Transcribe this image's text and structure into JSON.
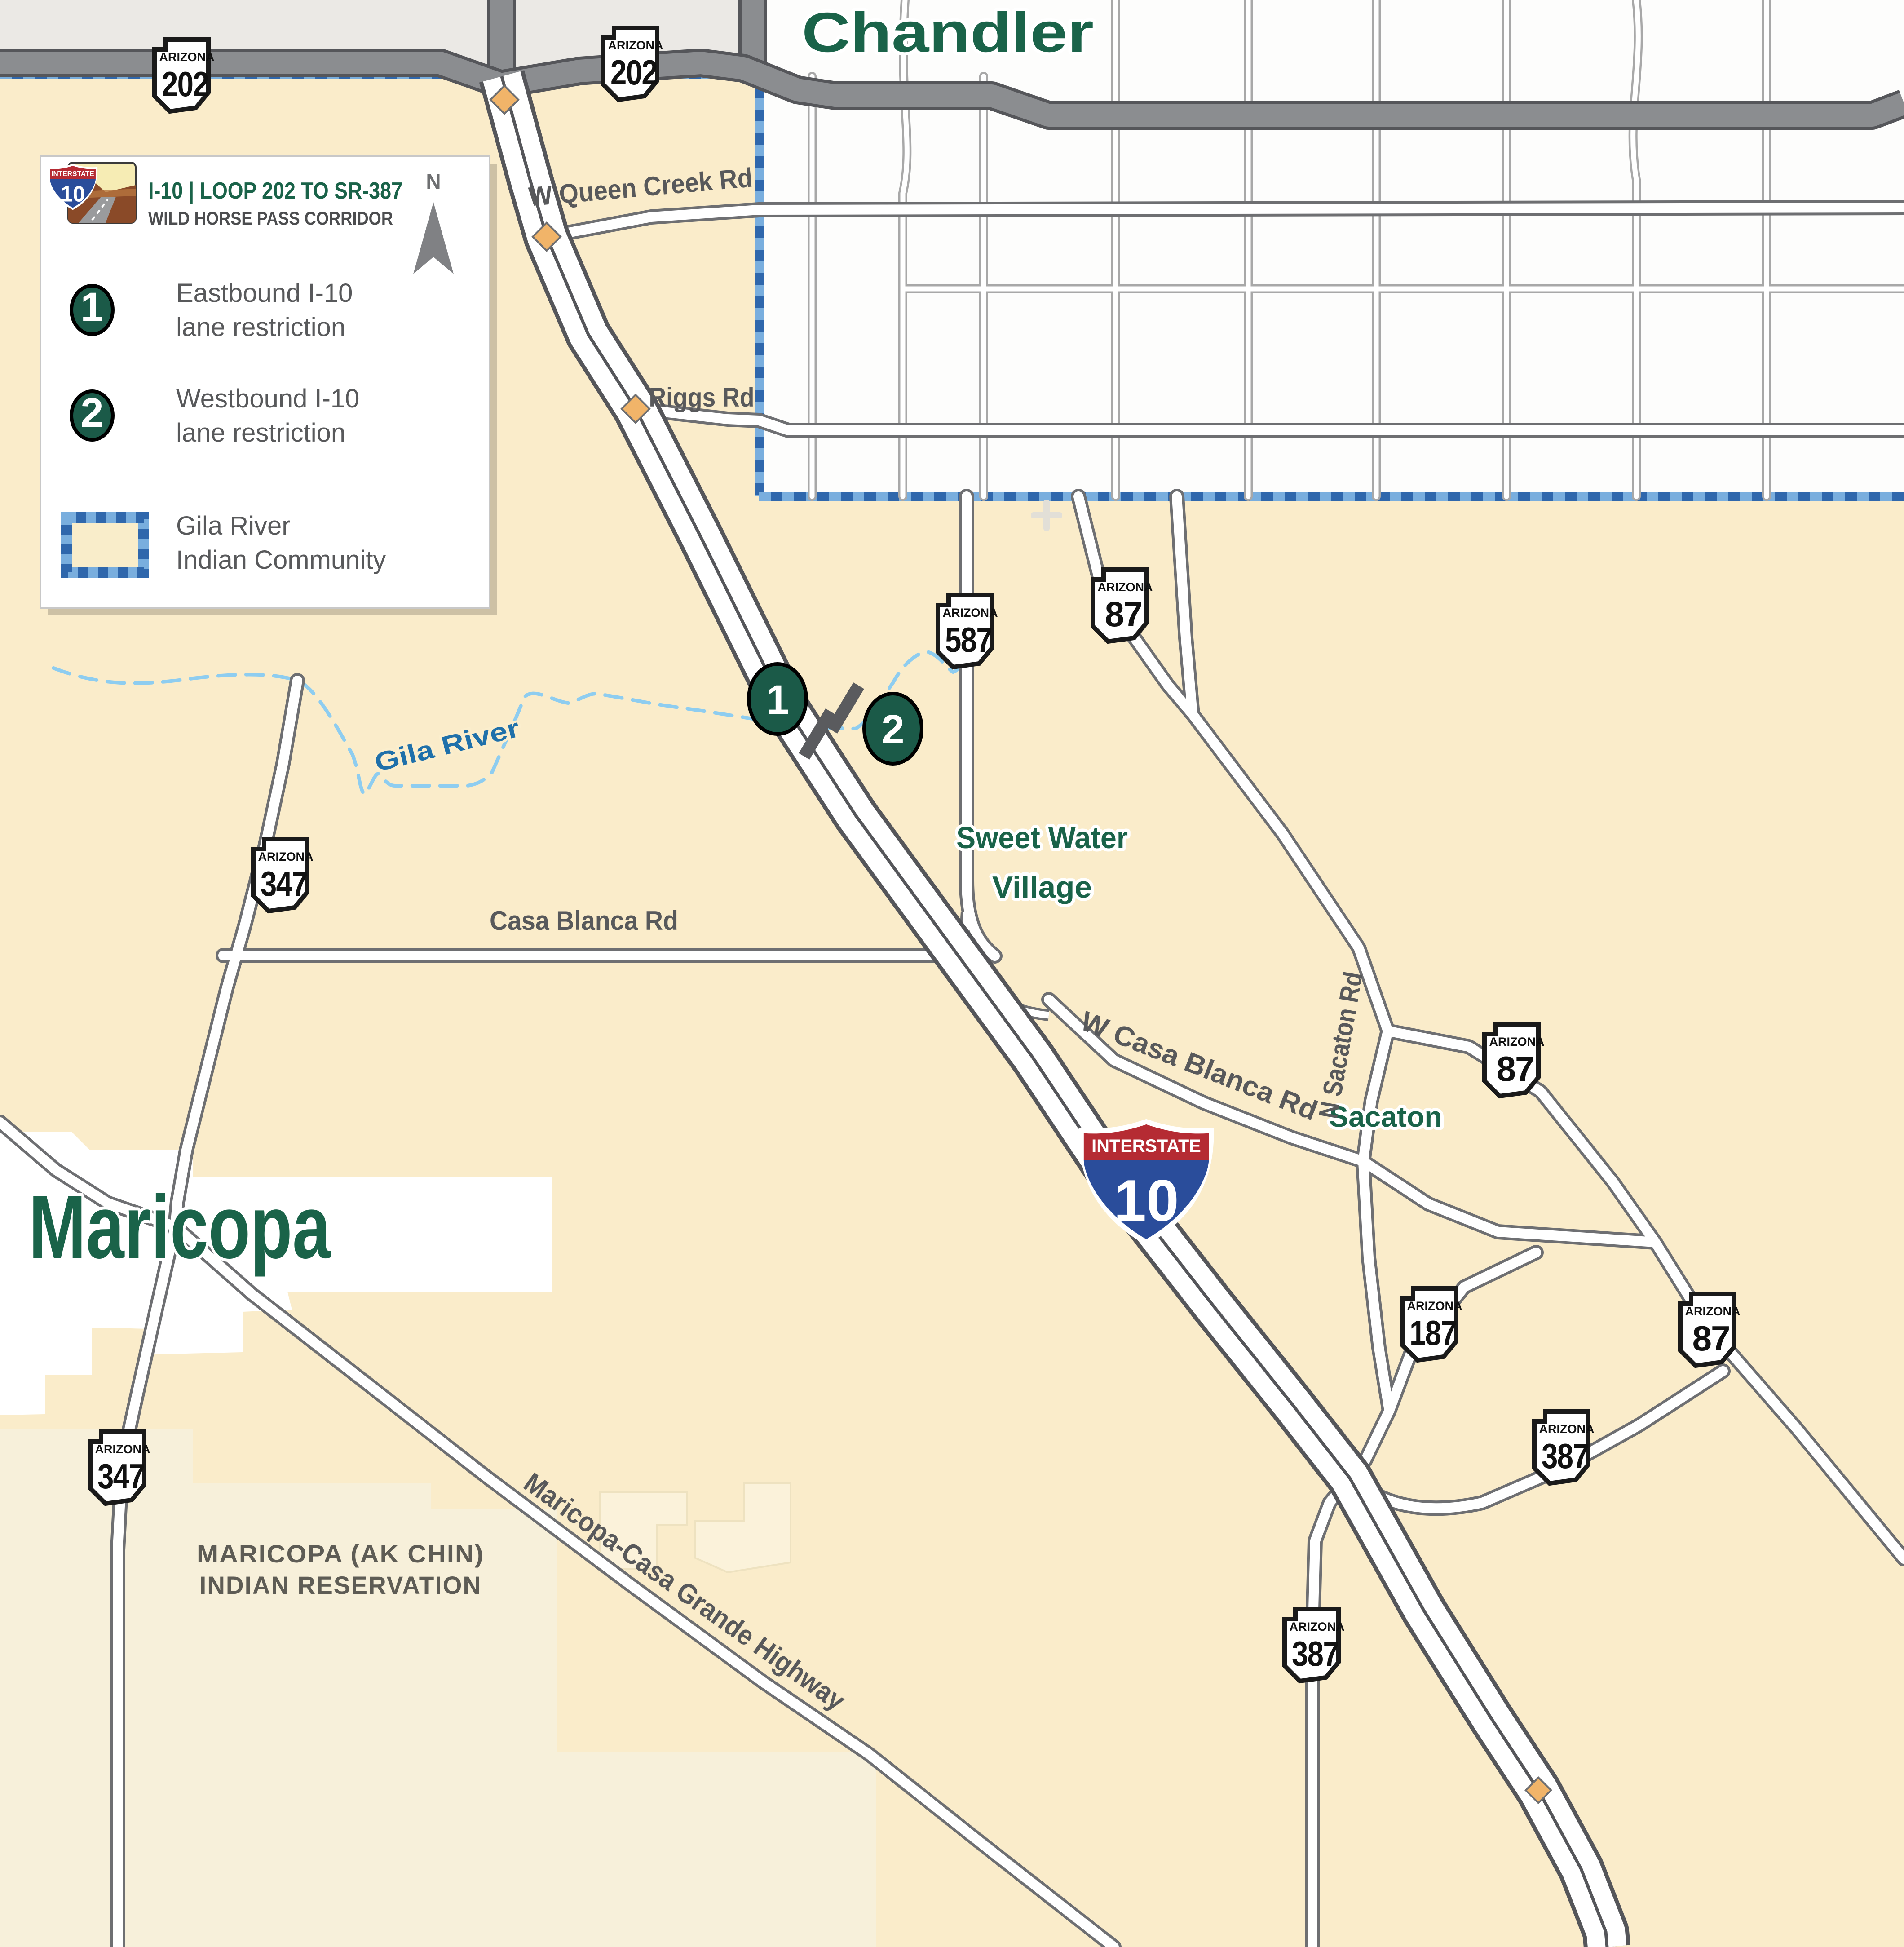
{
  "legend": {
    "title": "I-10 | LOOP 202 TO SR-387",
    "subtitle": "WILD HORSE PASS CORRIDOR",
    "north_label": "N",
    "icon": {
      "banner": "INTERSTATE",
      "route": "10"
    },
    "items": [
      {
        "marker": "1",
        "line1": "Eastbound I-10",
        "line2": "lane restriction"
      },
      {
        "marker": "2",
        "line1": "Westbound I-10",
        "line2": "lane restriction"
      },
      {
        "line1": "Gila River",
        "line2": "Indian Community"
      }
    ]
  },
  "map": {
    "cities": {
      "chandler": "Chandler",
      "maricopa": "Maricopa",
      "sacaton": "Sacaton"
    },
    "village": {
      "line1": "Sweet Water",
      "line2": "Village"
    },
    "reservation": {
      "line1": "MARICOPA (AK CHIN)",
      "line2": "INDIAN RESERVATION"
    },
    "river": "Gila River",
    "roads": {
      "queen_creek": "W Queen Creek Rd",
      "riggs": "Riggs Rd",
      "casa_blanca": "Casa Blanca Rd",
      "w_casa_blanca": "W Casa Blanca Rd",
      "n_sacaton": "N Sacaton Rd",
      "mcg": "Maricopa-Casa Grande Highway"
    },
    "markers": [
      {
        "label": "1"
      },
      {
        "label": "2"
      }
    ],
    "interstate": {
      "banner": "INTERSTATE",
      "route": "10"
    },
    "shield_state": "ARIZONA",
    "shields": {
      "s202a": "202",
      "s202b": "202",
      "s587": "587",
      "s87a": "87",
      "s347a": "347",
      "s87b": "87",
      "s187": "187",
      "s87c": "87",
      "s387a": "387",
      "s347b": "347",
      "s387b": "387"
    },
    "colors": {
      "land_tan": "#faecca",
      "akchin_light": "#f7f0da",
      "chandler_white": "#fdfdfc",
      "boundary_blue": "#2f67ac",
      "river_blue": "#8ecdf0",
      "city_green": "#1a6349",
      "road_gray_label": "#58595b",
      "interstate_blue": "#2a4d9b",
      "interstate_red": "#b52b33",
      "marker_green": "#1b5a48",
      "freeway_gray": "#8b8d90"
    }
  }
}
